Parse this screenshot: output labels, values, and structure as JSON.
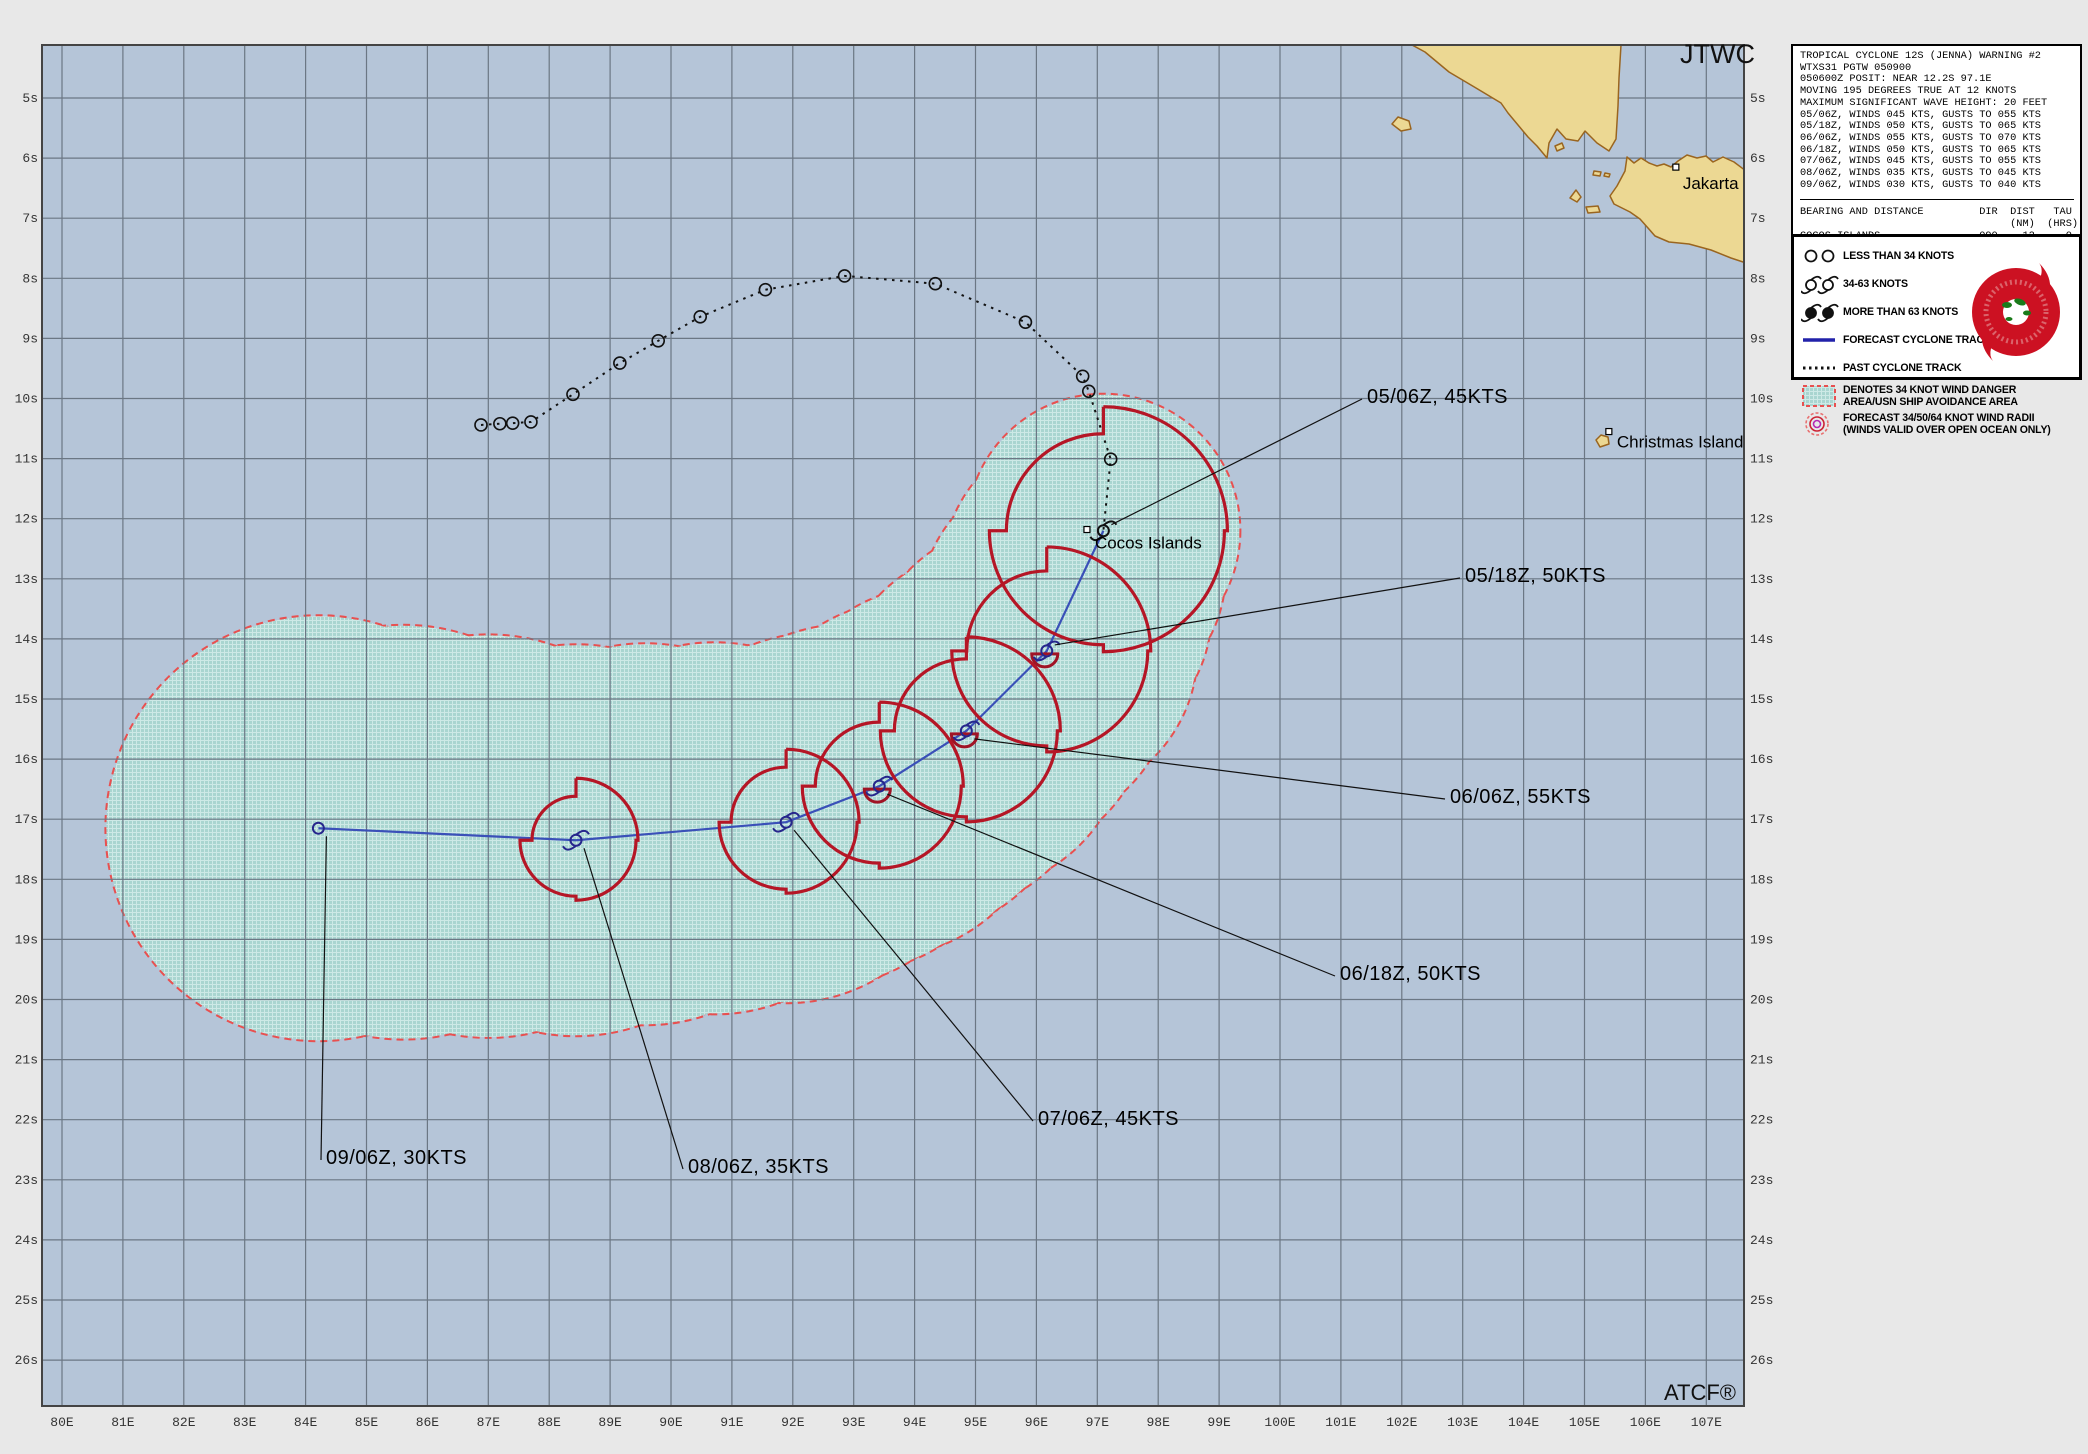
{
  "header": {
    "agency": "JTWC",
    "footer": "ATCF®"
  },
  "info_box": {
    "lines": [
      "TROPICAL CYCLONE 12S (JENNA) WARNING #2",
      "WTXS31 PGTW 050900",
      "050600Z POSIT: NEAR 12.2S 97.1E",
      "MOVING 195 DEGREES TRUE AT 12 KNOTS",
      "MAXIMUM SIGNIFICANT WAVE HEIGHT: 20 FEET",
      "05/06Z, WINDS 045 KTS, GUSTS TO 055 KTS",
      "05/18Z, WINDS 050 KTS, GUSTS TO 065 KTS",
      "06/06Z, WINDS 055 KTS, GUSTS TO 070 KTS",
      "06/18Z, WINDS 050 KTS, GUSTS TO 065 KTS",
      "07/06Z, WINDS 045 KTS, GUSTS TO 055 KTS",
      "08/06Z, WINDS 035 KTS, GUSTS TO 045 KTS",
      "09/06Z, WINDS 030 KTS, GUSTS TO 040 KTS"
    ],
    "table": [
      "BEARING AND DISTANCE         DIR  DIST   TAU",
      "                                  (NM)  (HRS)",
      "COCOS_ISLANDS                090    12     0"
    ]
  },
  "legend": {
    "items": [
      {
        "icon": "lt34-icon",
        "lines": [
          "LESS THAN 34 KNOTS"
        ]
      },
      {
        "icon": "kt3463-icon",
        "lines": [
          "34-63 KNOTS"
        ]
      },
      {
        "icon": "gt63-icon",
        "lines": [
          "MORE THAN 63 KNOTS"
        ]
      },
      {
        "icon": "fcst-track-icon",
        "lines": [
          "FORECAST CYCLONE TRACK"
        ]
      },
      {
        "icon": "past-track-icon",
        "lines": [
          "PAST CYCLONE TRACK"
        ]
      },
      {
        "icon": "danger-swatch-icon",
        "lines": [
          "DENOTES 34 KNOT WIND DANGER",
          "AREA/USN SHIP AVOIDANCE AREA"
        ]
      },
      {
        "icon": "wind-radii-icon",
        "lines": [
          "FORECAST 34/50/64 KNOT WIND RADII",
          "(WINDS VALID OVER OPEN OCEAN ONLY)"
        ]
      }
    ]
  },
  "places": [
    {
      "name": "Cocos Islands",
      "lon": 96.83,
      "lat": 12.18,
      "dx": 8,
      "dy": 19
    },
    {
      "name": "Christmas Island",
      "lon": 105.4,
      "lat": 10.55,
      "dx": 8,
      "dy": 16
    },
    {
      "name": "Jakarta",
      "lon": 106.5,
      "lat": 6.15,
      "dx": 7,
      "dy": 22
    }
  ],
  "axes": {
    "lon_labels": [
      "80E",
      "81E",
      "82E",
      "83E",
      "84E",
      "85E",
      "86E",
      "87E",
      "88E",
      "89E",
      "90E",
      "91E",
      "92E",
      "93E",
      "94E",
      "95E",
      "96E",
      "97E",
      "98E",
      "99E",
      "100E",
      "101E",
      "102E",
      "103E",
      "104E",
      "105E",
      "106E",
      "107E"
    ],
    "lat_labels": [
      "5s",
      "6s",
      "7s",
      "8s",
      "9s",
      "10s",
      "11s",
      "12s",
      "13s",
      "14s",
      "15s",
      "16s",
      "17s",
      "18s",
      "19s",
      "20s",
      "21s",
      "22s",
      "23s",
      "24s",
      "25s",
      "26s"
    ]
  },
  "chart_data": {
    "type": "map-track",
    "title": "TROPICAL CYCLONE 12S (JENNA) WARNING #2",
    "calibration": {
      "lon0": 80,
      "x0": 62,
      "px_per_lon": 60.9,
      "lat0": 5,
      "y0": 98,
      "px_per_lat": 60.1,
      "map_rect": [
        42,
        45,
        1702,
        1361
      ]
    },
    "past_track": [
      {
        "lon": 86.88,
        "lat": 10.44
      },
      {
        "lon": 87.19,
        "lat": 10.42
      },
      {
        "lon": 87.4,
        "lat": 10.41
      },
      {
        "lon": 87.7,
        "lat": 10.39
      },
      {
        "lon": 88.39,
        "lat": 9.93
      },
      {
        "lon": 89.16,
        "lat": 9.41
      },
      {
        "lon": 89.79,
        "lat": 9.04
      },
      {
        "lon": 90.48,
        "lat": 8.64
      },
      {
        "lon": 91.55,
        "lat": 8.19
      },
      {
        "lon": 92.85,
        "lat": 7.96
      },
      {
        "lon": 94.34,
        "lat": 8.09
      },
      {
        "lon": 95.82,
        "lat": 8.73
      },
      {
        "lon": 96.76,
        "lat": 9.63
      },
      {
        "lon": 96.86,
        "lat": 9.88
      },
      {
        "lon": 97.22,
        "lat": 11.01
      }
    ],
    "forecast": [
      {
        "time": "05/06Z",
        "wind_kt": 45,
        "label": "05/06Z, 45KTS",
        "lon": 97.1,
        "lat": 12.2,
        "r34": [
          124,
          121,
          114,
          97
        ],
        "r50": 0,
        "danger_r": 136,
        "label_x": 1367,
        "label_y": 403,
        "symbol": "storm"
      },
      {
        "time": "05/18Z",
        "wind_kt": 50,
        "label": "05/18Z, 50KTS",
        "lon": 96.17,
        "lat": 14.2,
        "r34": [
          104,
          101,
          95,
          80
        ],
        "r50": 13,
        "danger_r": 150,
        "label_x": 1465,
        "label_y": 582,
        "symbol": "storm"
      },
      {
        "time": "06/06Z",
        "wind_kt": 55,
        "label": "06/06Z, 55KTS",
        "lon": 94.85,
        "lat": 15.53,
        "r34": [
          94,
          91,
          86,
          72
        ],
        "r50": 13,
        "danger_r": 160,
        "label_x": 1450,
        "label_y": 803,
        "symbol": "storm"
      },
      {
        "time": "06/18Z",
        "wind_kt": 50,
        "label": "06/18Z, 50KTS",
        "lon": 93.42,
        "lat": 16.45,
        "r34": [
          84,
          82,
          77,
          64
        ],
        "r50": 13,
        "danger_r": 170,
        "label_x": 1340,
        "label_y": 980,
        "symbol": "storm"
      },
      {
        "time": "07/06Z",
        "wind_kt": 45,
        "label": "07/06Z, 45KTS",
        "lon": 91.89,
        "lat": 17.05,
        "r34": [
          73,
          71,
          67,
          55
        ],
        "r50": 0,
        "danger_r": 180,
        "label_x": 1038,
        "label_y": 1125,
        "symbol": "storm"
      },
      {
        "time": "08/06Z",
        "wind_kt": 35,
        "label": "08/06Z, 35KTS",
        "lon": 88.44,
        "lat": 17.35,
        "r34": [
          62,
          60,
          56,
          44
        ],
        "r50": 0,
        "danger_r": 195,
        "label_x": 688,
        "label_y": 1173,
        "symbol": "storm"
      },
      {
        "time": "09/06Z",
        "wind_kt": 30,
        "label": "09/06Z, 30KTS",
        "lon": 84.21,
        "lat": 17.15,
        "r34": null,
        "r50": 0,
        "danger_r": 212,
        "label_x": 326,
        "label_y": 1164,
        "symbol": "circle"
      }
    ]
  },
  "colors": {
    "ocean": "#b5c5d8",
    "margin": "#e8e8e8",
    "grid": "#6b7784",
    "land": "#ecd893",
    "coast": "#9a651f",
    "danger_fill": "#a9d5d0",
    "danger_hatch": "#cde9e6",
    "danger_border": "#e85050",
    "wind_radii": "#b51626",
    "radii_50": "#a01325",
    "forecast_track": "#3a50b8",
    "past_track": "#111111",
    "marker": "#26268c",
    "text": "#000000",
    "axis_text": "#333333"
  }
}
